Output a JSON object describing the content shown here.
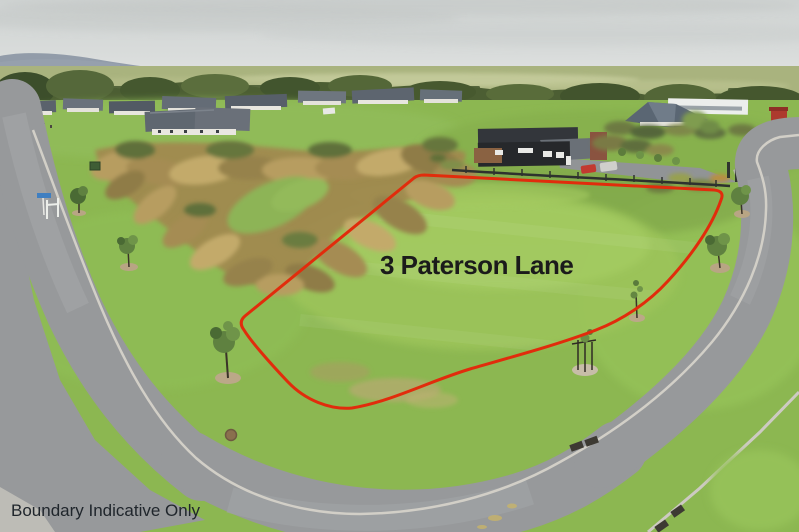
{
  "annotations": {
    "lot_label": "3 Paterson Lane",
    "disclaimer": "Boundary Indicative Only"
  },
  "colors": {
    "boundary_line": "#e12c0c",
    "lot_label_text": "#1b1b1b",
    "disclaimer_text": "#20262c"
  }
}
